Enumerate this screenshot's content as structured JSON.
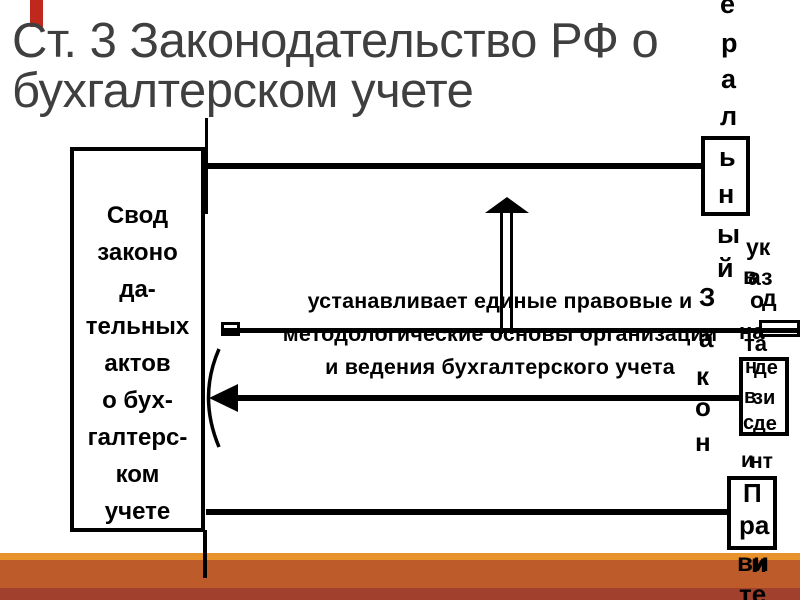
{
  "slide": {
    "title_lines": [
      "Ст. 3 Законодательство РФ о",
      "бухгалтерском учете"
    ],
    "source_box": {
      "lines": [
        "Свод",
        "законо",
        "да-",
        "тельных",
        "актов",
        "о бух-",
        "галтерс-",
        "ком",
        "учете"
      ]
    },
    "center_statement": {
      "lines": [
        "устанавливает единые правовые и",
        "методологические основы организации",
        "и ведения бухгалтерского учета"
      ]
    },
    "fragments": [
      {
        "group": "federal-law",
        "text": "е",
        "x": 720,
        "y": -9,
        "size": 27
      },
      {
        "group": "federal-law",
        "text": "р",
        "x": 721,
        "y": 30,
        "size": 27
      },
      {
        "group": "federal-law",
        "text": "а",
        "x": 721,
        "y": 66,
        "size": 27
      },
      {
        "group": "federal-law",
        "text": "л",
        "x": 720,
        "y": 103,
        "size": 27
      },
      {
        "group": "federal-law",
        "text": "ь",
        "x": 719,
        "y": 144,
        "size": 27
      },
      {
        "group": "federal-law",
        "text": "н",
        "x": 718,
        "y": 181,
        "size": 27
      },
      {
        "group": "federal-law",
        "text": "ы",
        "x": 717,
        "y": 221,
        "size": 27
      },
      {
        "group": "federal-law",
        "text": "й",
        "x": 717,
        "y": 255,
        "size": 27
      },
      {
        "group": "zakon",
        "text": "З",
        "x": 699,
        "y": 284,
        "size": 26
      },
      {
        "group": "zakon",
        "text": "а",
        "x": 699,
        "y": 325,
        "size": 26
      },
      {
        "group": "zakon",
        "text": "к",
        "x": 696,
        "y": 363,
        "size": 26
      },
      {
        "group": "zakon",
        "text": "о",
        "x": 695,
        "y": 394,
        "size": 26
      },
      {
        "group": "zakon",
        "text": "н",
        "x": 695,
        "y": 429,
        "size": 26
      },
      {
        "group": "ukazy",
        "text": "ук",
        "x": 746,
        "y": 236,
        "size": 23
      },
      {
        "group": "ukazy",
        "text": "в",
        "x": 743,
        "y": 265,
        "size": 23
      },
      {
        "group": "ukazy",
        "text": "аз",
        "x": 748,
        "y": 266,
        "size": 23
      },
      {
        "group": "ukazy",
        "text": "о",
        "x": 750,
        "y": 289,
        "size": 23
      },
      {
        "group": "ukazy",
        "text": "д",
        "x": 762,
        "y": 287,
        "size": 23
      },
      {
        "group": "president",
        "text": "на",
        "x": 739,
        "y": 321,
        "size": 22
      },
      {
        "group": "president",
        "text": "та",
        "x": 744,
        "y": 333,
        "size": 22
      },
      {
        "group": "president",
        "text": "н",
        "x": 745,
        "y": 357,
        "size": 20
      },
      {
        "group": "president",
        "text": "де",
        "x": 754,
        "y": 358,
        "size": 20
      },
      {
        "group": "president",
        "text": "в",
        "x": 744,
        "y": 387,
        "size": 20
      },
      {
        "group": "president",
        "text": "зи",
        "x": 753,
        "y": 388,
        "size": 20
      },
      {
        "group": "president",
        "text": "с",
        "x": 743,
        "y": 413,
        "size": 20
      },
      {
        "group": "president",
        "text": "де",
        "x": 753,
        "y": 414,
        "size": 20
      },
      {
        "group": "president",
        "text": "и",
        "x": 741,
        "y": 450,
        "size": 21
      },
      {
        "group": "president",
        "text": "нт",
        "x": 750,
        "y": 451,
        "size": 21
      },
      {
        "group": "government",
        "text": "П",
        "x": 743,
        "y": 480,
        "size": 26
      },
      {
        "group": "government",
        "text": "ра",
        "x": 739,
        "y": 512,
        "size": 26
      },
      {
        "group": "government",
        "text": "ви",
        "x": 737,
        "y": 549,
        "size": 26
      },
      {
        "group": "government",
        "text": "и",
        "x": 751,
        "y": 550,
        "size": 26
      },
      {
        "group": "government",
        "text": "те",
        "x": 739,
        "y": 581,
        "size": 26
      }
    ],
    "colors": {
      "title_gray": "#3f3f40",
      "ink": "#000000",
      "accent_red": "#c0281e",
      "footer_light_orange": "#e8922e",
      "footer_orange": "#bd5b2a",
      "footer_dark_red": "#a2402e"
    }
  }
}
